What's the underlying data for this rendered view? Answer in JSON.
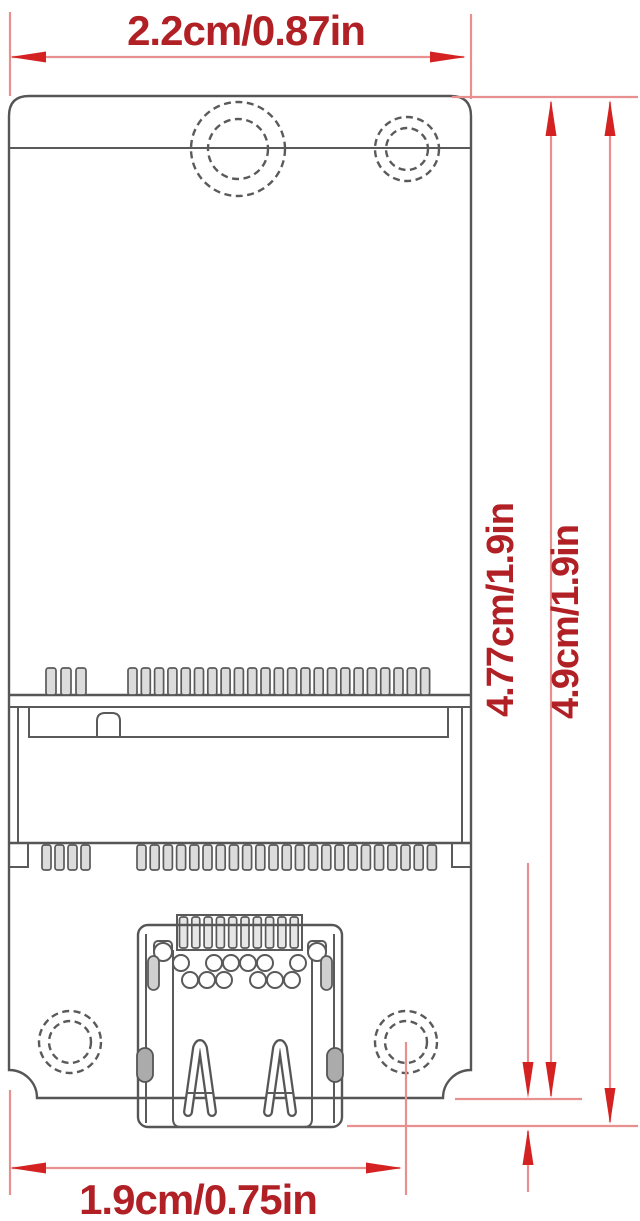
{
  "diagram": {
    "dimensions": {
      "top_width": "2.2cm/0.87in",
      "board_height": "4.77cm/1.9in",
      "overall_height": "4.9cm/1.9in",
      "bottom_width": "1.9cm/0.75in"
    },
    "colors": {
      "dimension_accent": "#d42222",
      "dimension_line": "#e89090",
      "label_text": "#b02025",
      "drawing_outline": "#565656",
      "background": "#ffffff"
    }
  }
}
